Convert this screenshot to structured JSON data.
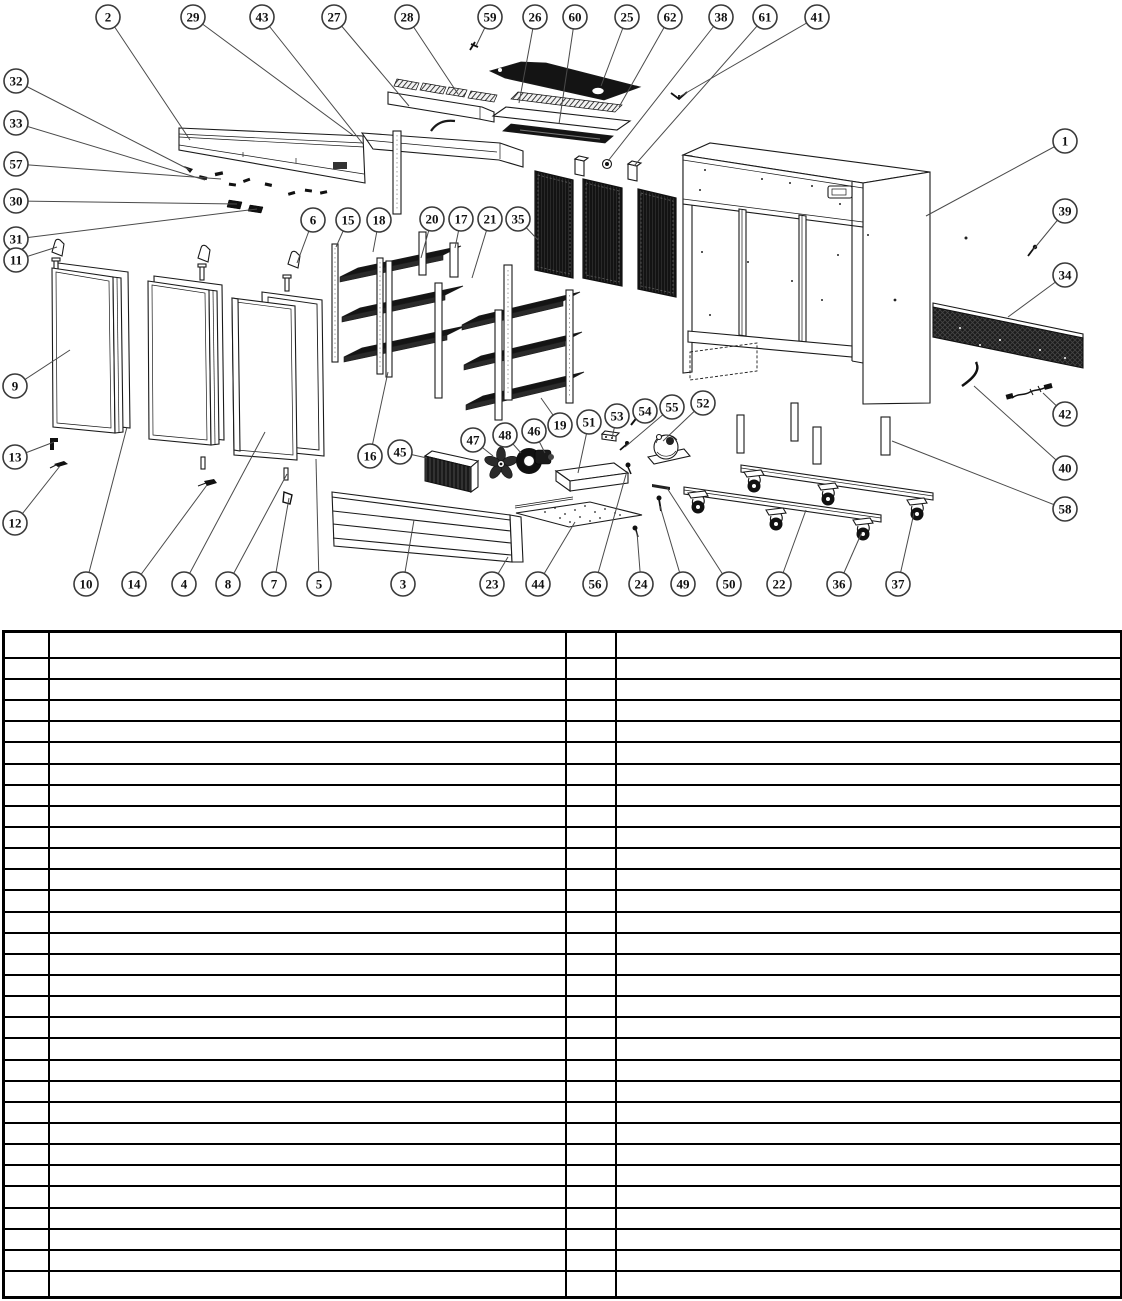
{
  "page": {
    "background": "#ffffff",
    "kind": "exploded-parts-diagram-page"
  },
  "diagram": {
    "description": "exploded view of refrigerated display cabinet",
    "style": {
      "line_color": "#1a1a1a",
      "leader_color": "#4a4a4a",
      "dark_fill": "#141414",
      "balloon_stroke": "#3a3a3a"
    },
    "callout_count": 62,
    "callouts": [
      {
        "n": "2",
        "cx": 108,
        "cy": 17,
        "tx": 190,
        "ty": 140
      },
      {
        "n": "29",
        "cx": 193,
        "cy": 17,
        "tx": 354,
        "ty": 136
      },
      {
        "n": "43",
        "cx": 262,
        "cy": 17,
        "tx": 363,
        "ty": 144
      },
      {
        "n": "27",
        "cx": 334,
        "cy": 17,
        "tx": 409,
        "ty": 106
      },
      {
        "n": "28",
        "cx": 407,
        "cy": 17,
        "tx": 458,
        "ty": 94
      },
      {
        "n": "59",
        "cx": 490,
        "cy": 17,
        "tx": 476,
        "ty": 46
      },
      {
        "n": "26",
        "cx": 535,
        "cy": 17,
        "tx": 519,
        "ty": 103
      },
      {
        "n": "60",
        "cx": 575,
        "cy": 17,
        "tx": 559,
        "ty": 124
      },
      {
        "n": "25",
        "cx": 627,
        "cy": 17,
        "tx": 601,
        "ty": 86
      },
      {
        "n": "62",
        "cx": 670,
        "cy": 17,
        "tx": 619,
        "ty": 107
      },
      {
        "n": "38",
        "cx": 721,
        "cy": 17,
        "tx": 608,
        "ty": 161
      },
      {
        "n": "61",
        "cx": 765,
        "cy": 17,
        "tx": 634,
        "ty": 166
      },
      {
        "n": "41",
        "cx": 817,
        "cy": 17,
        "tx": 679,
        "ty": 97
      },
      {
        "n": "32",
        "cx": 16,
        "cy": 81,
        "tx": 190,
        "ty": 170
      },
      {
        "n": "33",
        "cx": 16,
        "cy": 123,
        "tx": 205,
        "ty": 180
      },
      {
        "n": "57",
        "cx": 16,
        "cy": 164,
        "tx": 221,
        "ty": 179
      },
      {
        "n": "30",
        "cx": 16,
        "cy": 201,
        "tx": 237,
        "ty": 204
      },
      {
        "n": "31",
        "cx": 16,
        "cy": 239,
        "tx": 257,
        "ty": 209
      },
      {
        "n": "11",
        "cx": 16,
        "cy": 260,
        "tx": 57,
        "ty": 247
      },
      {
        "n": "9",
        "cx": 15,
        "cy": 386,
        "tx": 70,
        "ty": 350
      },
      {
        "n": "13",
        "cx": 15,
        "cy": 457,
        "tx": 54,
        "ty": 442
      },
      {
        "n": "12",
        "cx": 15,
        "cy": 523,
        "tx": 60,
        "ty": 466
      },
      {
        "n": "6",
        "cx": 313,
        "cy": 220,
        "tx": 297,
        "ty": 263
      },
      {
        "n": "15",
        "cx": 348,
        "cy": 220,
        "tx": 336,
        "ty": 247
      },
      {
        "n": "18",
        "cx": 379,
        "cy": 220,
        "tx": 373,
        "ty": 252
      },
      {
        "n": "20",
        "cx": 432,
        "cy": 219,
        "tx": 421,
        "ty": 258
      },
      {
        "n": "17",
        "cx": 461,
        "cy": 219,
        "tx": 455,
        "ty": 248
      },
      {
        "n": "21",
        "cx": 490,
        "cy": 219,
        "tx": 472,
        "ty": 278
      },
      {
        "n": "35",
        "cx": 518,
        "cy": 219,
        "tx": 538,
        "ty": 240
      },
      {
        "n": "16",
        "cx": 370,
        "cy": 456,
        "tx": 388,
        "ty": 372
      },
      {
        "n": "45",
        "cx": 400,
        "cy": 452,
        "tx": 427,
        "ty": 458
      },
      {
        "n": "47",
        "cx": 473,
        "cy": 440,
        "tx": 493,
        "ty": 456
      },
      {
        "n": "48",
        "cx": 505,
        "cy": 435,
        "tx": 521,
        "ty": 453
      },
      {
        "n": "46",
        "cx": 534,
        "cy": 431,
        "tx": 545,
        "ty": 453
      },
      {
        "n": "19",
        "cx": 560,
        "cy": 425,
        "tx": 541,
        "ty": 398
      },
      {
        "n": "51",
        "cx": 589,
        "cy": 422,
        "tx": 578,
        "ty": 473
      },
      {
        "n": "53",
        "cx": 617,
        "cy": 416,
        "tx": 612,
        "ty": 438
      },
      {
        "n": "54",
        "cx": 645,
        "cy": 411,
        "tx": 636,
        "ty": 419
      },
      {
        "n": "55",
        "cx": 672,
        "cy": 407,
        "tx": 625,
        "ty": 447
      },
      {
        "n": "52",
        "cx": 703,
        "cy": 403,
        "tx": 663,
        "ty": 441
      },
      {
        "n": "10",
        "cx": 86,
        "cy": 584,
        "tx": 127,
        "ty": 427
      },
      {
        "n": "14",
        "cx": 134,
        "cy": 584,
        "tx": 207,
        "ty": 485
      },
      {
        "n": "4",
        "cx": 184,
        "cy": 584,
        "tx": 265,
        "ty": 432
      },
      {
        "n": "8",
        "cx": 228,
        "cy": 584,
        "tx": 287,
        "ty": 474
      },
      {
        "n": "7",
        "cx": 274,
        "cy": 584,
        "tx": 289,
        "ty": 498
      },
      {
        "n": "5",
        "cx": 319,
        "cy": 584,
        "tx": 316,
        "ty": 459
      },
      {
        "n": "3",
        "cx": 403,
        "cy": 584,
        "tx": 414,
        "ty": 520
      },
      {
        "n": "23",
        "cx": 492,
        "cy": 584,
        "tx": 508,
        "ty": 557
      },
      {
        "n": "44",
        "cx": 538,
        "cy": 584,
        "tx": 575,
        "ty": 522
      },
      {
        "n": "56",
        "cx": 595,
        "cy": 584,
        "tx": 627,
        "ty": 471
      },
      {
        "n": "24",
        "cx": 641,
        "cy": 584,
        "tx": 637,
        "ty": 532
      },
      {
        "n": "49",
        "cx": 683,
        "cy": 584,
        "tx": 660,
        "ty": 506
      },
      {
        "n": "50",
        "cx": 729,
        "cy": 584,
        "tx": 667,
        "ty": 488
      },
      {
        "n": "22",
        "cx": 779,
        "cy": 584,
        "tx": 806,
        "ty": 510
      },
      {
        "n": "36",
        "cx": 839,
        "cy": 584,
        "tx": 862,
        "ty": 532
      },
      {
        "n": "37",
        "cx": 898,
        "cy": 584,
        "tx": 914,
        "ty": 513
      },
      {
        "n": "1",
        "cx": 1065,
        "cy": 141,
        "tx": 926,
        "ty": 216
      },
      {
        "n": "39",
        "cx": 1065,
        "cy": 211,
        "tx": 1033,
        "ty": 250
      },
      {
        "n": "34",
        "cx": 1065,
        "cy": 275,
        "tx": 1008,
        "ty": 317
      },
      {
        "n": "42",
        "cx": 1065,
        "cy": 414,
        "tx": 1043,
        "ty": 393
      },
      {
        "n": "40",
        "cx": 1065,
        "cy": 468,
        "tx": 974,
        "ty": 386
      },
      {
        "n": "58",
        "cx": 1065,
        "cy": 509,
        "tx": 892,
        "ty": 441
      }
    ]
  },
  "parts_table": {
    "row_count": 31,
    "cells_empty": true,
    "columns": [
      {
        "name": "item-no-left",
        "width": 45
      },
      {
        "name": "description-left",
        "width": 517
      },
      {
        "name": "item-no-right",
        "width": 50
      },
      {
        "name": "description-right",
        "width": 506
      }
    ]
  }
}
